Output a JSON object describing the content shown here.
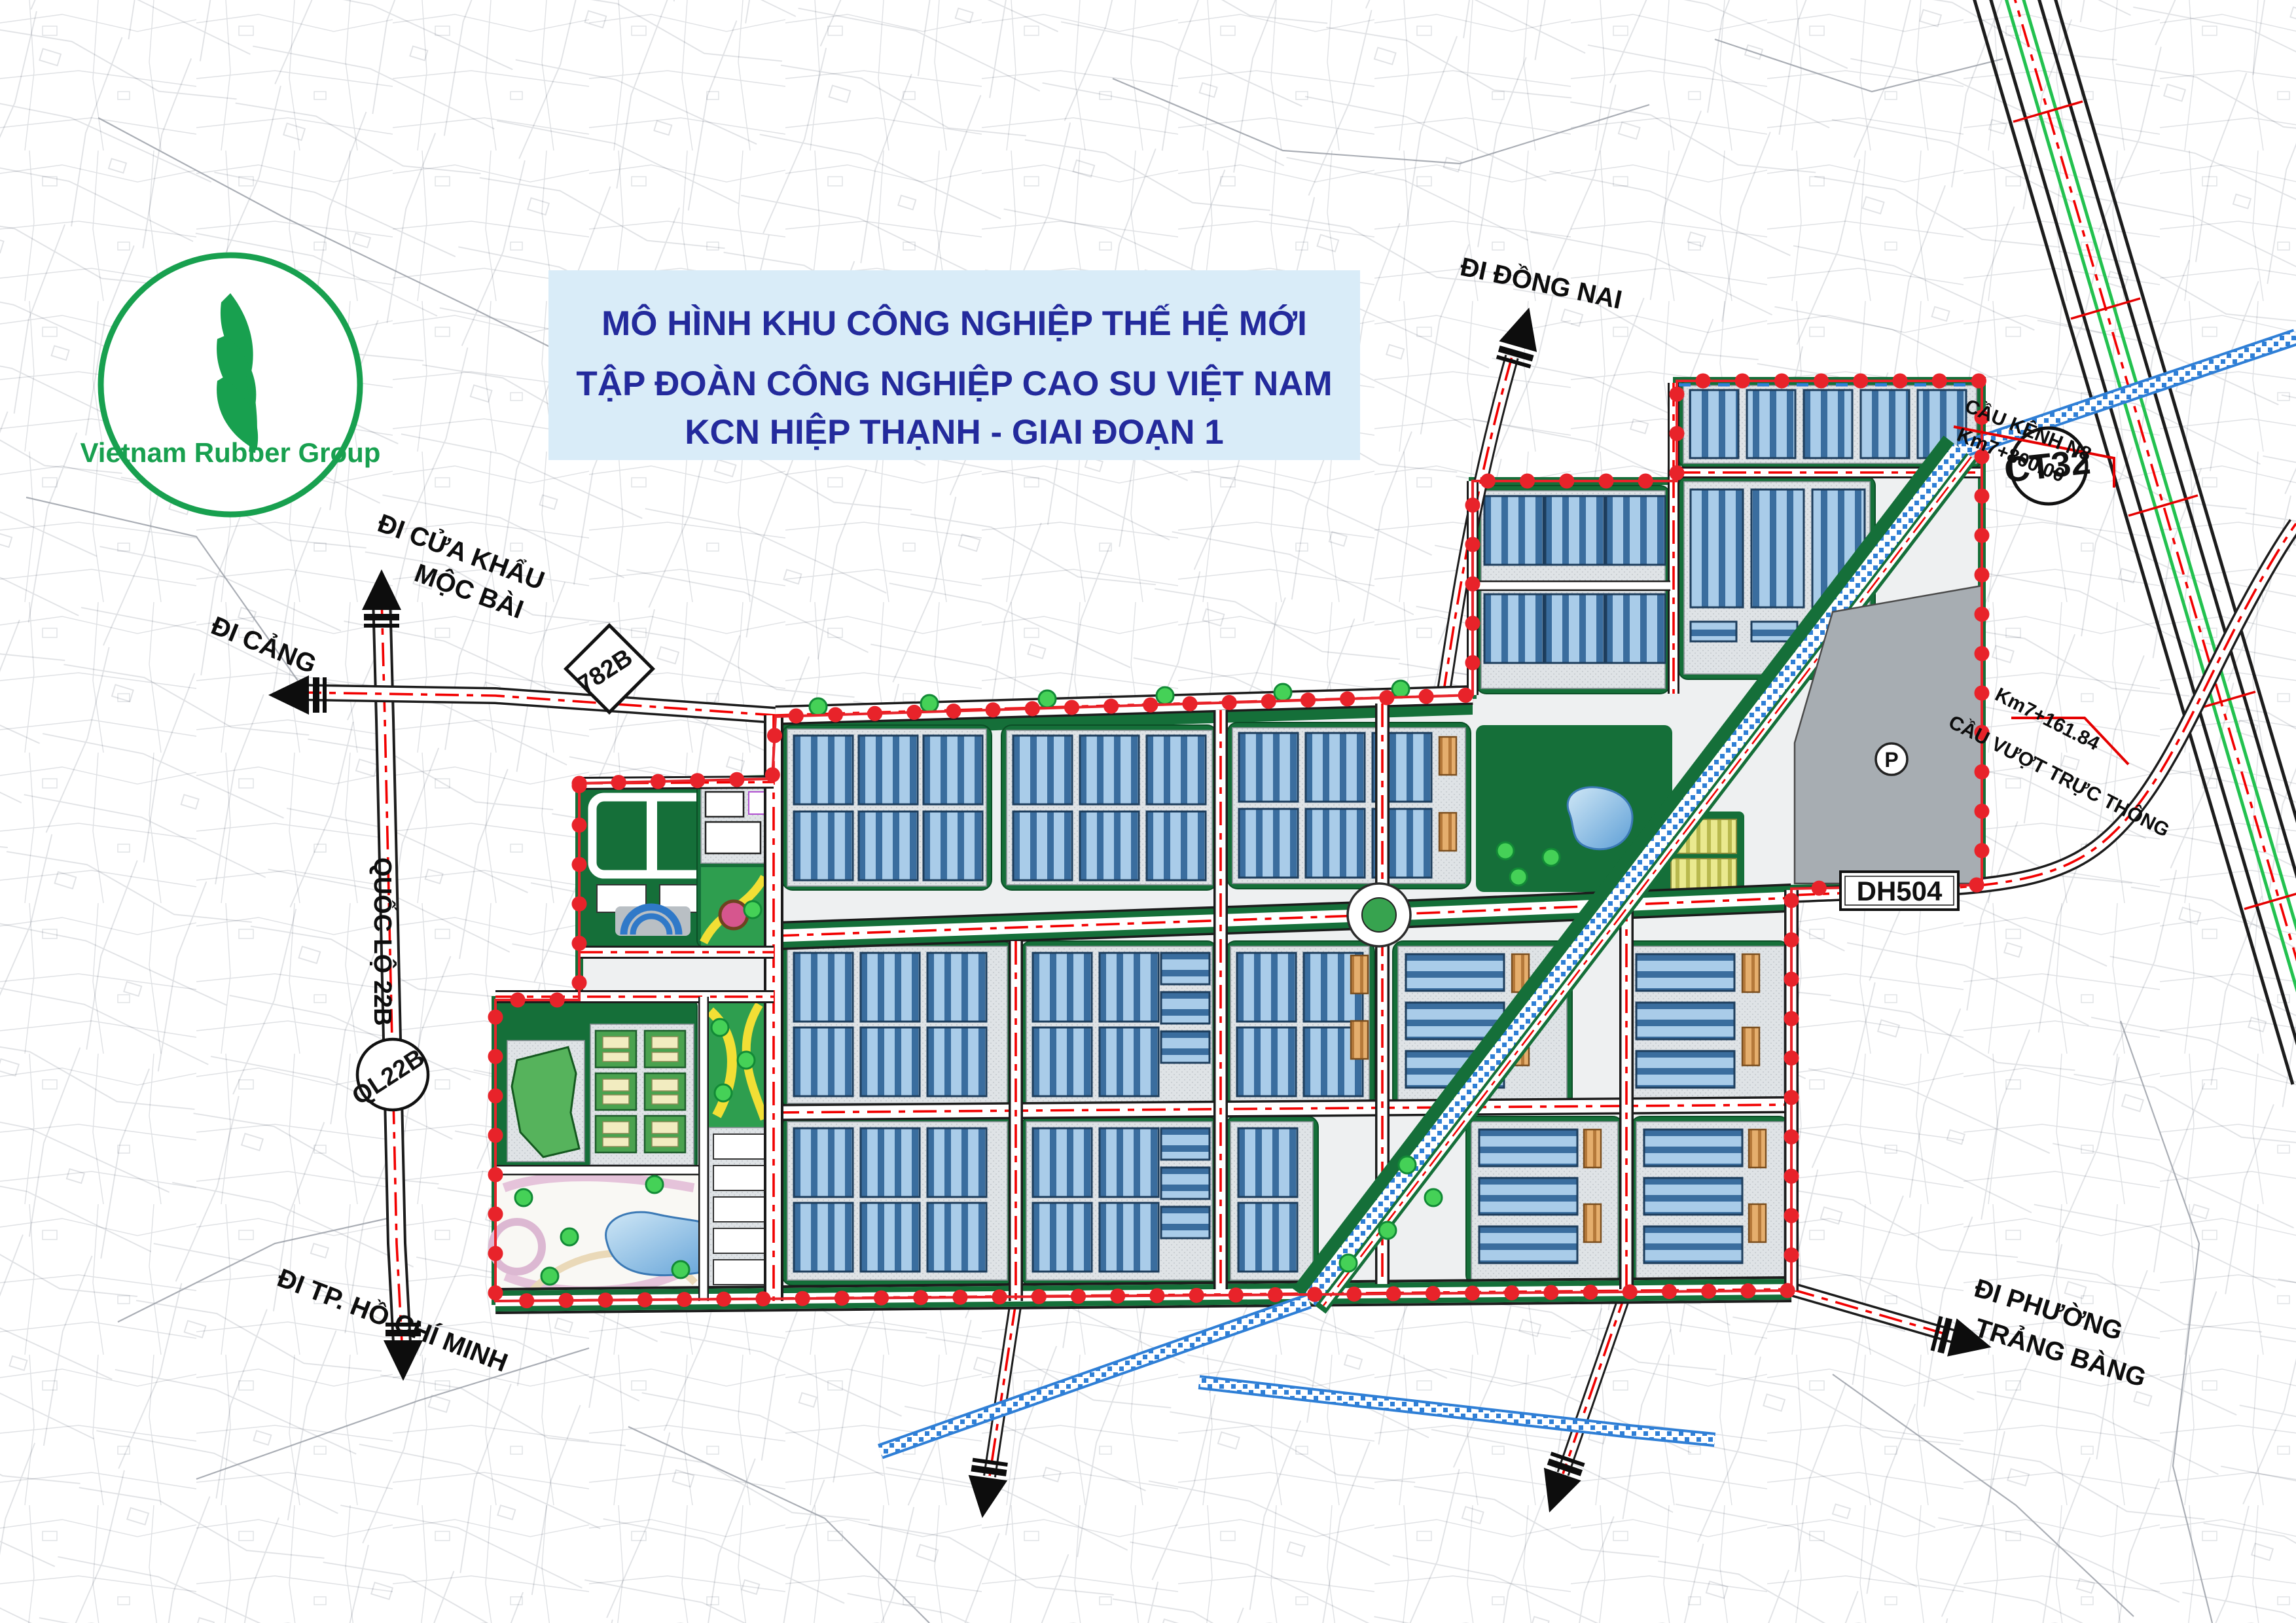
{
  "title": {
    "line1": "MÔ HÌNH KHU CÔNG NGHIỆP THẾ HỆ MỚI",
    "line2": "TẬP ĐOÀN CÔNG NGHIỆP CAO SU VIỆT NAM",
    "line3": "KCN HIỆP THẠNH - GIAI ĐOẠN 1"
  },
  "logo": {
    "name": "Vietnam Rubber Group"
  },
  "labels": {
    "moc_bai_1": "ĐI CỬA KHẨU",
    "moc_bai_2": "MỘC BÀI",
    "cang": "ĐI CẢNG",
    "quoc_lo": "QUỐC LỘ 22B",
    "ql22b": "QL22B",
    "r782b": "782B",
    "hcm": "ĐI TP. HỒ CHÍ MINH",
    "dong_nai": "ĐI ĐỒNG NAI",
    "ct32": "CT32",
    "cau_kenh": "CẦU KÊNH N8",
    "km7_800": "Km7+800.00",
    "cau_vuot": "CẦU VƯỢT TRỰC THÔNG",
    "km7_161": "Km7+161.84",
    "dh504": "DH504",
    "trang_bang_1": "ĐI PHƯỜNG",
    "trang_bang_2": "TRẢNG BÀNG",
    "parking": "P"
  },
  "colors": {
    "title_bg": "#d9ecf8",
    "title_text": "#232a9c",
    "logo_green": "#18a04f",
    "boundary_red": "#e8232a",
    "road_centerline_red": "#f20000",
    "park_green": "#156f39",
    "lot_gray": "#dfe3e6",
    "factory_blue_dark": "#3a6d9e",
    "factory_blue_light": "#a9cce9",
    "factory_orange": "#e5ae6d",
    "canal_blue": "#2f7fd6",
    "expressway_green": "#23c14f",
    "parcel_gray": "#bfc2c8"
  }
}
